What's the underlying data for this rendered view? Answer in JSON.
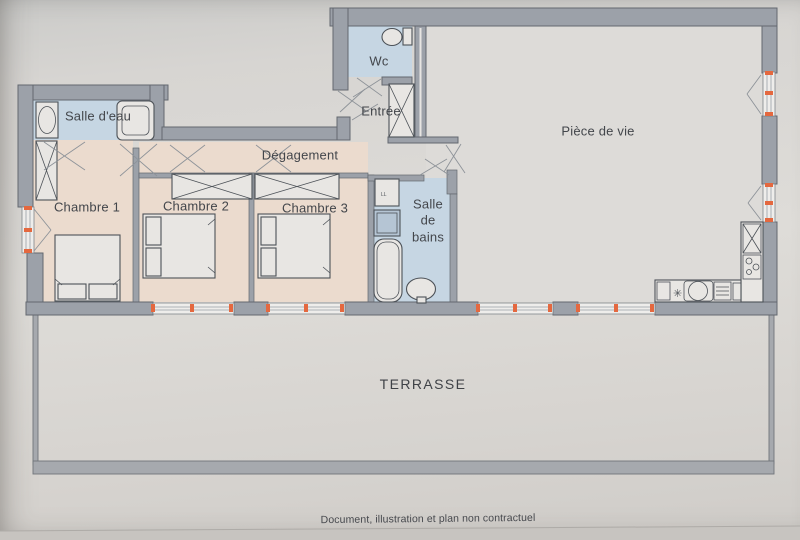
{
  "rooms": [
    {
      "id": "wc",
      "name": "Wc"
    },
    {
      "id": "entree",
      "name": "Entrée"
    },
    {
      "id": "piece-de-vie",
      "name": "Pièce de vie"
    },
    {
      "id": "salle-deau",
      "name": "Salle d'eau"
    },
    {
      "id": "degagement",
      "name": "Dégagement"
    },
    {
      "id": "chambre-1",
      "name": "Chambre 1"
    },
    {
      "id": "chambre-2",
      "name": "Chambre 2"
    },
    {
      "id": "chambre-3",
      "name": "Chambre 3"
    },
    {
      "id": "salle-de-bains",
      "name": "Salle de bains"
    },
    {
      "id": "terrasse",
      "name": "TERRASSE"
    }
  ],
  "footer": {
    "note": "Document, illustration et plan non contractuel"
  },
  "icons": {
    "burner": "✳",
    "washing_machine_label": "LL"
  },
  "colors": {
    "paper": "#dbd9d5",
    "wall": "#9ca1a9",
    "wall_dark": "#63686f",
    "wet": "#c6d6e3",
    "bedroom": "#ebdbce",
    "tick": "#e4683f",
    "line": "#4d5258",
    "furn": "#e8e6e3",
    "door": "#8e9399",
    "terr": "#a6a9ae",
    "text": "#43464b"
  }
}
